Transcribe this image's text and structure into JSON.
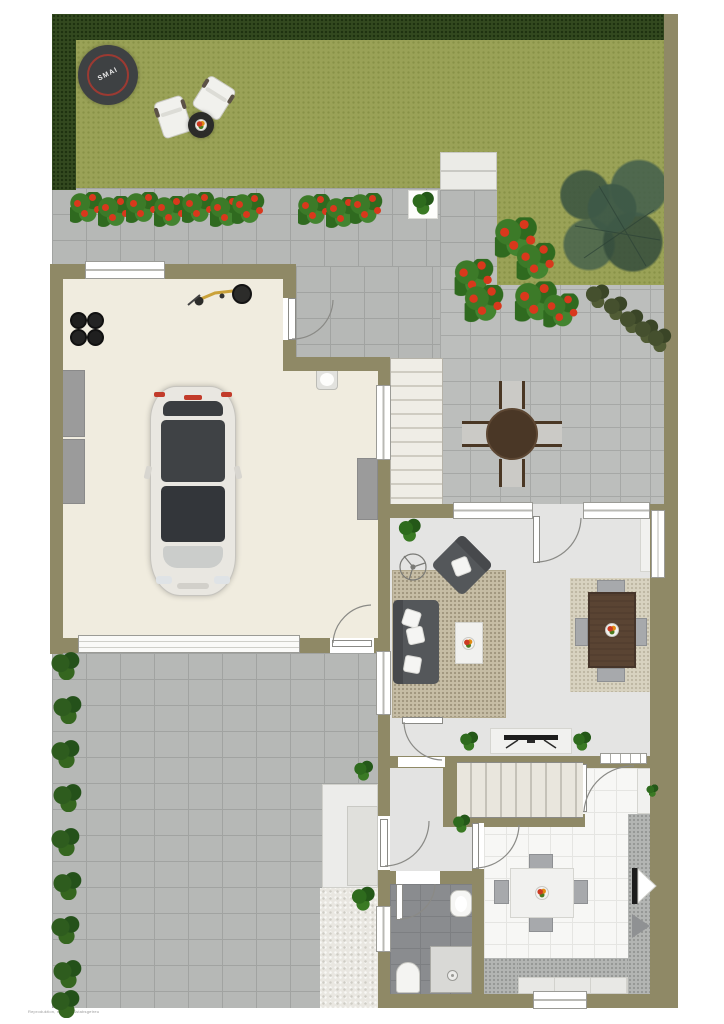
{
  "scene": {
    "description": "Top-down rendered site and ground-floor plan of a house with garden, garage, patio, living room, kitchen and bathroom",
    "trampoline_logo": "SMAI",
    "watermark": "Reproduktion, nicht maßstabsgetreu"
  },
  "palette": {
    "wall_olive": "#8f8966",
    "lawn_green": "#9aa257",
    "hedge_dark_green": "#33491f",
    "paver_gray": "#b6b8b6",
    "garage_floor_cream": "#f0ecdf",
    "interior_floor_gray": "#e4e4e3",
    "kitchen_tile_white": "#f7f7f5",
    "bathroom_tile_gray": "#8a8c8f",
    "living_rug_beige": "#c6bda5",
    "dining_rug_beige": "#d8d2c0",
    "sofa_dark_gray": "#54575a",
    "wood_dark_brown": "#4a3726",
    "flower_red": "#d9381c",
    "plant_green": "#3c7a28",
    "tree_green": "#3e5947",
    "trampoline_ring_red": "#9c3a32"
  },
  "areas": {
    "garden": [
      "hedge-top",
      "hedge-left",
      "lawn",
      "trampoline",
      "lounge-chairs",
      "garden-side-table",
      "flower-bed",
      "planter-box",
      "garden-steps",
      "tree",
      "boundary-wall"
    ],
    "patio": [
      "paver-terrace",
      "round-dining-table",
      "four-patio-chairs",
      "flower-bushes",
      "diagonal-shrub-row",
      "exterior-stairs"
    ],
    "garage": [
      "car",
      "bicycle",
      "tire-stack",
      "storage-cabinets",
      "workbench",
      "utility-sink",
      "garage-door",
      "side-door"
    ],
    "living_room": [
      "sofa",
      "armchair",
      "coffee-table",
      "area-rug",
      "ceiling-fan",
      "potted-plant",
      "dining-table",
      "four-dining-chairs",
      "dining-rug",
      "built-in-shelf"
    ],
    "hall": [
      "tv-sideboard",
      "tv",
      "staircase",
      "potted-plants"
    ],
    "entry": [
      "front-door",
      "vestibule"
    ],
    "bathroom": [
      "washbasin",
      "toilet",
      "shower"
    ],
    "kitchen": [
      "kitchen-table",
      "four-kitchen-chairs",
      "fruit-bowl",
      "counter-right",
      "counter-bottom",
      "refrigerator",
      "window"
    ],
    "driveway": [
      "paver-driveway",
      "hedge-bush-row",
      "storage-boxes",
      "gravel-area"
    ]
  },
  "decorations": {
    "bed_flowers": [
      [
        70,
        192
      ],
      [
        98,
        196
      ],
      [
        126,
        192
      ],
      [
        154,
        196
      ],
      [
        182,
        192
      ],
      [
        210,
        196
      ],
      [
        232,
        193
      ],
      [
        298,
        194
      ],
      [
        326,
        197
      ],
      [
        350,
        193
      ]
    ],
    "patio_flowers": [
      [
        500,
        222,
        1.3
      ],
      [
        520,
        246,
        1.2
      ],
      [
        458,
        262,
        1.2
      ],
      [
        468,
        288,
        1.2
      ],
      [
        520,
        286,
        1.3
      ],
      [
        545,
        295,
        1.1
      ]
    ],
    "hedge_bushes": [
      [
        50,
        652
      ],
      [
        52,
        696
      ],
      [
        50,
        740
      ],
      [
        52,
        784
      ],
      [
        50,
        828
      ],
      [
        52,
        872
      ],
      [
        50,
        916
      ],
      [
        52,
        960
      ],
      [
        50,
        990
      ]
    ],
    "diagonal_shrubs": [
      [
        583,
        283
      ],
      [
        601,
        295
      ],
      [
        617,
        308
      ],
      [
        632,
        318
      ],
      [
        645,
        327
      ]
    ],
    "potted_plants": [
      [
        396,
        518,
        26
      ],
      [
        458,
        731,
        21
      ],
      [
        571,
        731,
        21
      ],
      [
        451,
        814,
        20
      ],
      [
        645,
        784,
        14
      ],
      [
        352,
        760,
        22
      ],
      [
        349,
        886,
        27
      ],
      [
        410,
        191,
        25
      ]
    ]
  }
}
